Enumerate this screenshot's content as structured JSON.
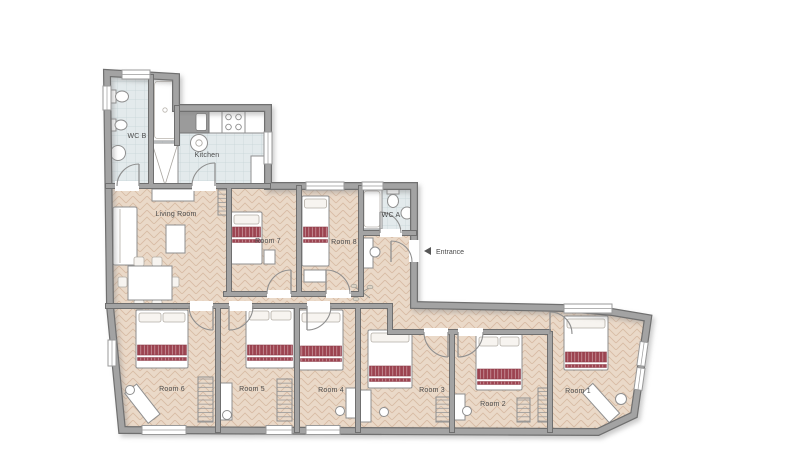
{
  "page": {
    "type": "apartment-floor-plan",
    "background": "#ffffff"
  },
  "colors": {
    "wall": "#a3a3a3",
    "wall_edge": "#6f6f6f",
    "wood": "#ead9c8",
    "wood_line": "#d8bca5",
    "tile": "#e3eaec",
    "tile_line": "#c6d3d6",
    "bed_stripe": "#9c4350",
    "label": "#4a4a4a"
  },
  "rooms": {
    "wc_b": {
      "label": "WC B"
    },
    "kitchen": {
      "label": "Kitchen"
    },
    "living_room": {
      "label": "Living Room"
    },
    "room7": {
      "label": "Room 7"
    },
    "room8": {
      "label": "Room 8"
    },
    "wc_a": {
      "label": "WC A"
    },
    "room6": {
      "label": "Room 6"
    },
    "room5": {
      "label": "Room 5"
    },
    "room4": {
      "label": "Room 4"
    },
    "room3": {
      "label": "Room 3"
    },
    "room2": {
      "label": "Room 2"
    },
    "room1": {
      "label": "Room 1"
    }
  },
  "entrance": {
    "label": "Entrance",
    "arrow_direction": "left"
  }
}
